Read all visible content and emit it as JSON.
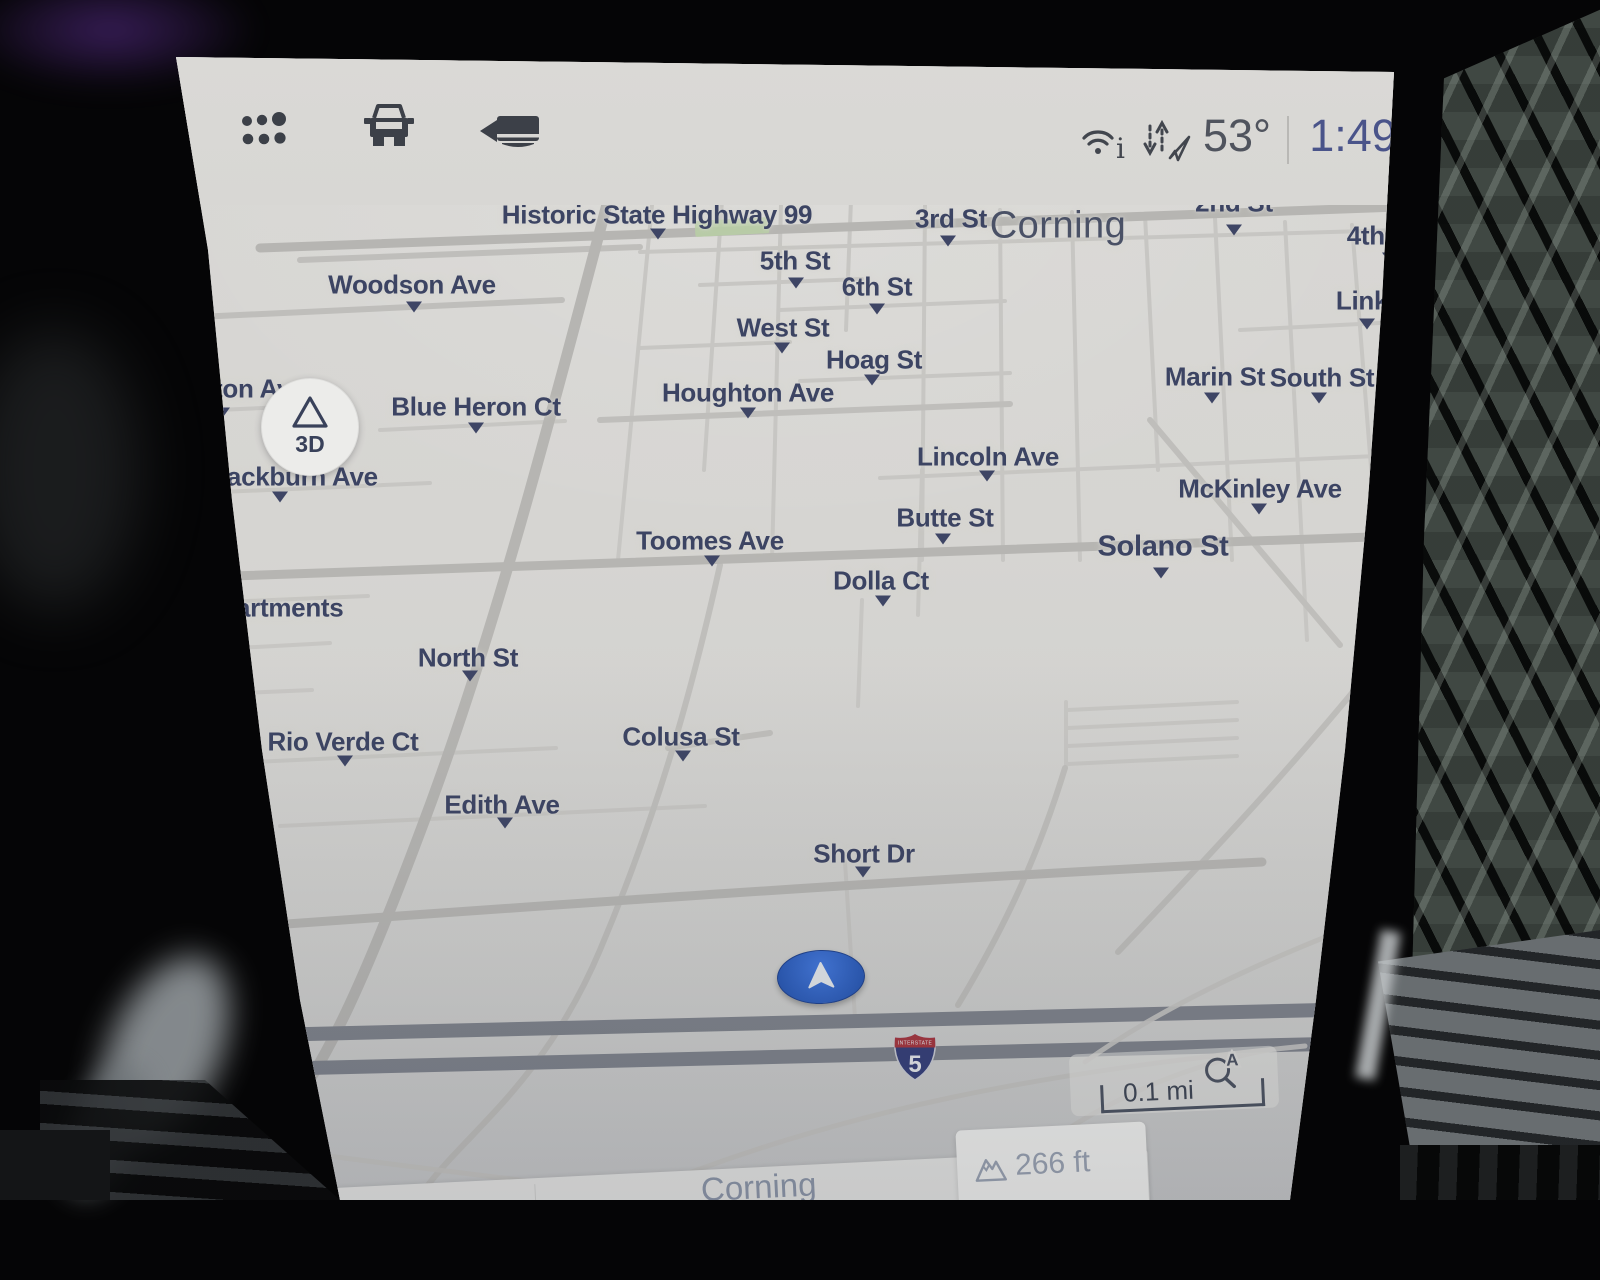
{
  "status_bar": {
    "apps_icon": "app-grid-icon",
    "vehicle_icon": "vehicle-icon",
    "camera_icon": "rear-camera-icon",
    "wifi_icon": "wifi-info-icon",
    "gps_icon": "gps-arrows-icon",
    "temperature": "53°",
    "time": "1:49"
  },
  "map": {
    "view_button_label": "3D",
    "scale_label": "0.1 mi",
    "auto_zoom_letter": "A",
    "shield": {
      "band": "INTERSTATE",
      "number": "5"
    },
    "colors": {
      "map_background": "#d6d5d2",
      "street_label": "#3c4463",
      "road_minor": "#c7c6c3",
      "road_major": "#b6b5b2",
      "interstate_band": "#7d818a",
      "vehicle_marker_blue": "#2f66cc",
      "greenery_patch": "#b9cfa5"
    },
    "streets": [
      {
        "name": "Historic State Highway 99",
        "x": 657,
        "y": 215,
        "mx": 658,
        "my": 234
      },
      {
        "name": "3rd St",
        "x": 951,
        "y": 219,
        "mx": 948,
        "my": 241
      },
      {
        "name": "Corning",
        "x": 1058,
        "y": 226,
        "size": 38,
        "cls": "city"
      },
      {
        "name": "2nd St",
        "x": 1234,
        "y": 203,
        "mx": 1234,
        "my": 230
      },
      {
        "name": "4th A",
        "x": 1378,
        "y": 236,
        "mx": 1390,
        "my": 258
      },
      {
        "name": "5th St",
        "x": 795,
        "y": 261,
        "mx": 796,
        "my": 283
      },
      {
        "name": "6th St",
        "x": 877,
        "y": 287,
        "mx": 877,
        "my": 309
      },
      {
        "name": "Woodson Ave",
        "x": 412,
        "y": 285,
        "mx": 414,
        "my": 307
      },
      {
        "name": "West St",
        "x": 783,
        "y": 328,
        "mx": 782,
        "my": 348
      },
      {
        "name": "Hoag St",
        "x": 874,
        "y": 360,
        "mx": 872,
        "my": 380
      },
      {
        "name": "Link S",
        "x": 1374,
        "y": 301,
        "mx": 1367,
        "my": 324
      },
      {
        "name": "Marin St",
        "x": 1215,
        "y": 377,
        "mx": 1212,
        "my": 398
      },
      {
        "name": "South St",
        "x": 1322,
        "y": 378,
        "mx": 1319,
        "my": 398
      },
      {
        "name": "Houghton Ave",
        "x": 748,
        "y": 393,
        "mx": 748,
        "my": 413
      },
      {
        "name": "ton Av",
        "x": 214,
        "y": 389,
        "cut": "left",
        "mx": 222,
        "my": 413
      },
      {
        "name": "Blue Heron Ct",
        "x": 476,
        "y": 407,
        "mx": 476,
        "my": 428
      },
      {
        "name": "lackburn Ave",
        "x": 220,
        "y": 477,
        "cut": "left",
        "mx": 280,
        "my": 497
      },
      {
        "name": "Lincoln Ave",
        "x": 988,
        "y": 457,
        "mx": 987,
        "my": 476
      },
      {
        "name": "McKinley Ave",
        "x": 1260,
        "y": 489,
        "mx": 1259,
        "my": 509
      },
      {
        "name": "Butte St",
        "x": 945,
        "y": 518,
        "mx": 943,
        "my": 539
      },
      {
        "name": "Toomes Ave",
        "x": 710,
        "y": 541,
        "mx": 712,
        "my": 561
      },
      {
        "name": "Solano St",
        "x": 1163,
        "y": 547,
        "size": 29,
        "mx": 1161,
        "my": 573
      },
      {
        "name": "Dolla Ct",
        "x": 881,
        "y": 581,
        "mx": 883,
        "my": 601
      },
      {
        "name": "artments",
        "x": 236,
        "y": 608,
        "cut": "left"
      },
      {
        "name": "North St",
        "x": 468,
        "y": 658,
        "mx": 470,
        "my": 676
      },
      {
        "name": "Rio Verde Ct",
        "x": 343,
        "y": 742,
        "mx": 345,
        "my": 761
      },
      {
        "name": "Colusa St",
        "x": 681,
        "y": 737,
        "mx": 683,
        "my": 756
      },
      {
        "name": "Edith Ave",
        "x": 502,
        "y": 805,
        "mx": 505,
        "my": 823
      },
      {
        "name": "Short Dr",
        "x": 864,
        "y": 854,
        "mx": 863,
        "my": 872
      }
    ]
  },
  "bottom_bar": {
    "location": "Corning",
    "elevation": "266 ft"
  }
}
